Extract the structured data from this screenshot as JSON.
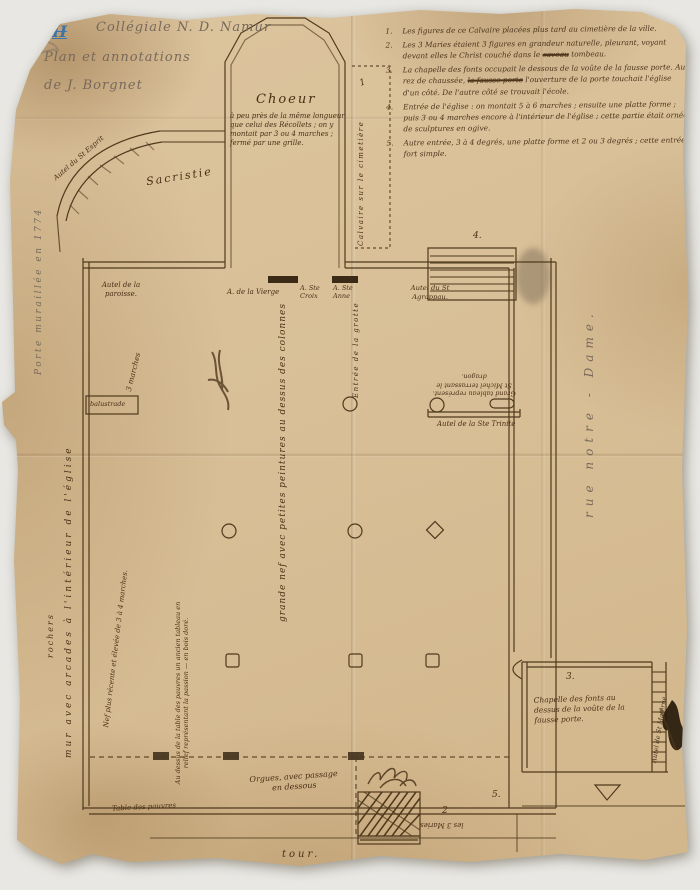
{
  "document": {
    "title_block": {
      "index": "II",
      "title": "Collégiale N. D. Namur",
      "line2": "Plan et annotations",
      "line3": "de J. Borgnet"
    },
    "notes": [
      {
        "num": "1.",
        "t1": "Les figures de ce Calvaire placées plus tard au cimetière de la ville.",
        "strike": "",
        "t2": ""
      },
      {
        "num": "2.",
        "t1": "Les 3 Maries étaient 3 figures en grandeur naturelle, pleurant, voyant devant elles le Christ couché dans le ",
        "strike": "caveau",
        "t2": " tombeau."
      },
      {
        "num": "3.",
        "t1": "La chapelle des fonts occupait le dessous de la voûte de la fausse porte. Au rez de chaussée, ",
        "strike": "la fausse porte",
        "t2": " l'ouverture de la porte touchait l'église d'un côté. De l'autre côté se trouvait l'école."
      },
      {
        "num": "4.",
        "t1": "Entrée de l'église : on montait 5 à 6 marches ; ensuite une platte forme ; puis 3 ou 4 marches encore à l'intérieur de l'église ; cette partie était ornée de sculptures en ogive.",
        "strike": "",
        "t2": ""
      },
      {
        "num": "5.",
        "t1": "Autre entrée, 3 à 4 degrés, une platte forme et 2 ou 3 degrés ; cette entrée fort simple.",
        "strike": "",
        "t2": ""
      }
    ],
    "plan": {
      "choeur": "Choeur",
      "choeur_note": "à peu près de la même longueur que celui des Récollets ; on y montait par 3 ou 4 marches ; fermé par une grille.",
      "sacristie": "Sacristie",
      "autel_st_esprit": "Autel du St Esprit",
      "calvaire": "Calvaire sur le cimetière",
      "marker_1": "1",
      "autel_paroisse": "Autel de la paroisse.",
      "a_vierge": "A. de la Vierge",
      "a_ste_croix": "A. Ste Croix",
      "a_ste_anne": "A. Ste Anne",
      "autel_st_agrappau": "Autel du St Agrappau.",
      "entree_grotte": "Entrée de la grotte",
      "marker_4": "4.",
      "tableau_st_michel": "Grand tableau représent. St Michel terrassant le dragon.",
      "autel_trinite": "Autel de la Ste Trinité",
      "grande_nef": "grande nef avec petites peintures au dessus des colonnes",
      "rue": "rue notre - Dame.",
      "porte_muree": "Porte muraillée en 1774",
      "trois_marches": "3 marches",
      "balustrade": "balustrade",
      "rochers": "rochers",
      "mur_arcades": "mur avec arcades à l'intérieur de l'église",
      "nef_recente": "Nef plus récente et élevée de 3 à 4 marches.",
      "tableau_passion": "Au dessus de la table des pauvres un ancien tableau en relief représentant la passion — en bois doré.",
      "table_pauvres": "Table des pauvres",
      "orgues": "Orgues, avec passage en dessous",
      "tour": "tour.",
      "marker_2": "2",
      "les_trois_maries": "les 3 Maries",
      "marker_3": "3.",
      "chapelle_fonts": "Chapelle des fonts au dessus de la voûte de la fausse porte.",
      "autel_materne": "Autel de St Materne",
      "marker_5": "5."
    },
    "colors": {
      "paper": "#d8bf97",
      "ink": "#4a3016",
      "pencil": "#77695a",
      "blue_pencil": "#3f74a8"
    }
  }
}
